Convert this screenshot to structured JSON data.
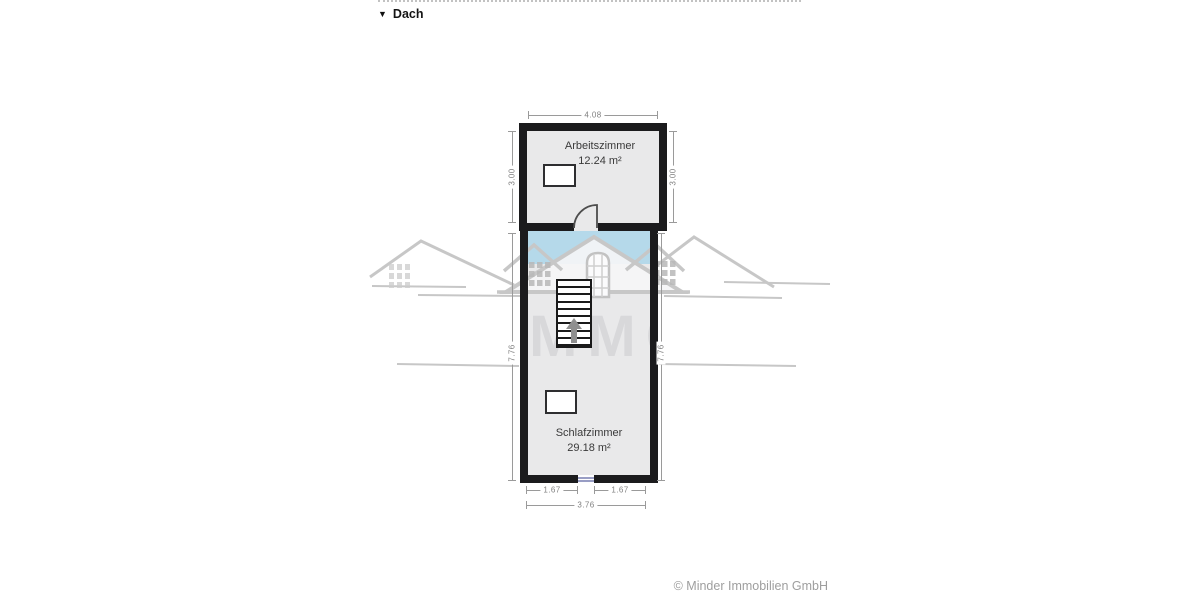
{
  "header": {
    "collapse_icon": "▼",
    "label": "Dach"
  },
  "plan": {
    "rooms": [
      {
        "name": "Arbeitszimmer",
        "area": "12.24 m²"
      },
      {
        "name": "Schlafzimmer",
        "area": "29.18 m²"
      }
    ],
    "dimensions": {
      "upper_width": "4.08",
      "upper_height_left": "3.00",
      "upper_height_right": "3.00",
      "lower_height_left": "7.76",
      "lower_height_right": "7.76",
      "bottom_segment_left": "1.67",
      "bottom_segment_right": "1.67",
      "bottom_total": "3.76"
    }
  },
  "watermark": {
    "text": "IMMO"
  },
  "footer": {
    "credit": "© Minder Immobilien GmbH"
  },
  "colors": {
    "wall": "#1b1b1d",
    "room_fill": "#e9e9ea",
    "roof_glass_blue": "#b5d9ea",
    "dimension_line": "#9a9a9a",
    "watermark_gray": "#c7c7c7",
    "bottom_window_blue": "#989dc4"
  }
}
